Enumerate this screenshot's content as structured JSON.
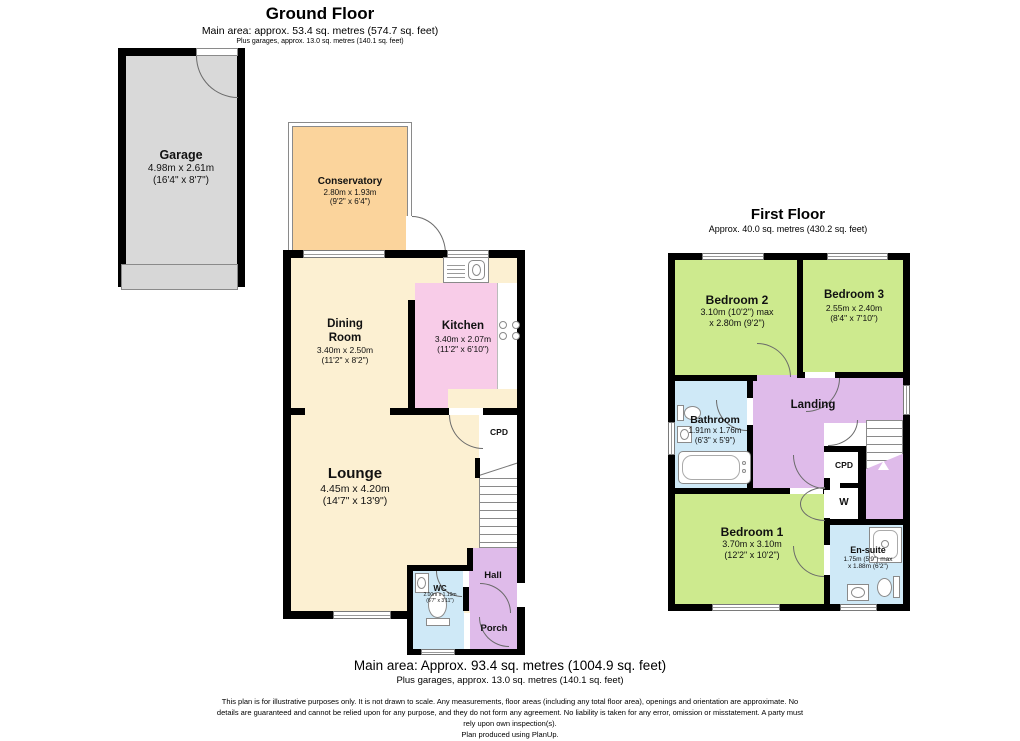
{
  "colors": {
    "wall": "#000000",
    "garage_fill": "#d9d9d9",
    "conservatory_fill": "#fbd49c",
    "cream_fill": "#fcf0d2",
    "kitchen_fill": "#f8cce8",
    "blue_fill": "#cfe9f7",
    "purple_fill": "#dfbbea",
    "green_fill": "#cdea8e"
  },
  "ground_floor": {
    "title": "Ground Floor",
    "area_line": "Main area: approx. 53.4 sq. metres (574.7 sq. feet)",
    "garage_line": "Plus garages, approx. 13.0 sq. metres (140.1 sq. feet)",
    "rooms": {
      "garage": {
        "name": "Garage",
        "metric": "4.98m x 2.61m",
        "imperial": "(16'4\" x 8'7\")"
      },
      "conservatory": {
        "name": "Conservatory",
        "metric": "2.80m x 1.93m",
        "imperial": "(9'2\" x 6'4\")"
      },
      "dining_room": {
        "name": "Dining Room",
        "metric": "3.40m x 2.50m",
        "imperial": "(11'2\" x 8'2\")"
      },
      "kitchen": {
        "name": "Kitchen",
        "metric": "3.40m x 2.07m",
        "imperial": "(11'2\" x 6'10\")"
      },
      "lounge": {
        "name": "Lounge",
        "metric": "4.45m x 4.20m",
        "imperial": "(14'7\" x 13'9\")"
      },
      "wc": {
        "name": "WC",
        "metric": "2.00m x 1.19m",
        "imperial": "(6'7\" x 3'11\")"
      },
      "cpd": {
        "name": "CPD"
      },
      "hall": {
        "name": "Hall"
      },
      "porch": {
        "name": "Porch"
      }
    }
  },
  "first_floor": {
    "title": "First Floor",
    "area_line": "Approx. 40.0 sq. metres (430.2 sq. feet)",
    "rooms": {
      "bedroom2": {
        "name": "Bedroom 2",
        "metric": "3.10m (10'2\") max",
        "imperial": "x 2.80m (9'2\")"
      },
      "bedroom3": {
        "name": "Bedroom 3",
        "metric": "2.55m x 2.40m",
        "imperial": "(8'4\" x 7'10\")"
      },
      "bathroom": {
        "name": "Bathroom",
        "metric": "1.91m x 1.76m",
        "imperial": "(6'3\" x 5'9\")"
      },
      "landing": {
        "name": "Landing"
      },
      "cpd": {
        "name": "CPD"
      },
      "wardrobe": {
        "name": "W"
      },
      "bedroom1": {
        "name": "Bedroom 1",
        "metric": "3.70m x 3.10m",
        "imperial": "(12'2\" x 10'2\")"
      },
      "ensuite": {
        "name": "En-suite",
        "metric": "1.75m (5'9\") max",
        "imperial": "x 1.88m (6'2\")"
      }
    }
  },
  "footer": {
    "main_area": "Main area: Approx. 93.4 sq. metres (1004.9 sq. feet)",
    "garage_area": "Plus garages, approx. 13.0 sq. metres (140.1 sq. feet)",
    "disclaimer_line1": "This plan is for illustrative purposes only. It is not drawn to scale. Any measurements, floor areas (including any total floor area), openings and orientation are approximate. No",
    "disclaimer_line2": "details are guaranteed and cannot be relied upon for any purpose, and they do not form any agreement. No liability is taken for any error, omission or misstatement. A party must",
    "disclaimer_line3": "rely upon own inspection(s).",
    "disclaimer_line4": "Plan produced using PlanUp."
  }
}
